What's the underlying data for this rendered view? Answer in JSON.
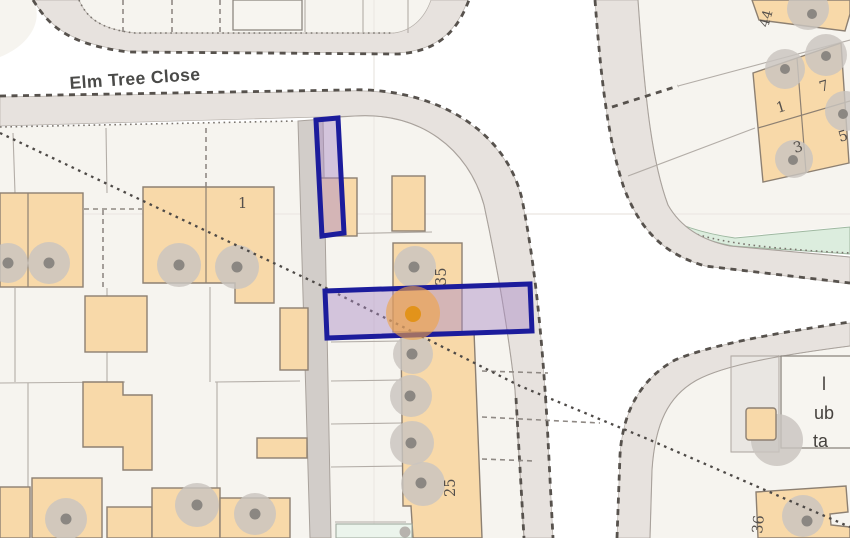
{
  "map": {
    "street": {
      "label": "Elm Tree Close"
    },
    "plots": {
      "house_1": "1",
      "terrace_35": "35",
      "terrace_25": "25",
      "block_44": "44",
      "unit_1": "1",
      "unit_7": "7",
      "unit_3": "3",
      "unit_5": "5",
      "house_36": "36"
    },
    "club_building_fragments": {
      "line1": "l",
      "line2": "ub",
      "line3": "ta"
    },
    "colors": {
      "selection_outline": "#1c1c9c",
      "selection_fill": "rgba(168,138,198,0.45)",
      "marker_halo": "rgba(240,163,68,0.6)",
      "marker_dot": "#e2931a",
      "building_fill": "#f8d9a9",
      "road_fill": "#e7e2de",
      "parcel_fill": "#f6f4ef",
      "green_verge": "#dcedde"
    }
  }
}
